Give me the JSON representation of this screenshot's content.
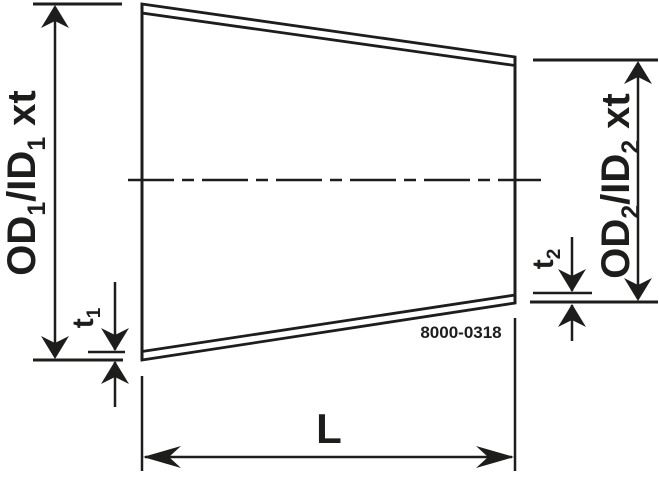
{
  "part_number": "8000-0318",
  "labels": {
    "left_diameter": {
      "p1": "OD",
      "s1": "1",
      "p2": "/ID",
      "s2": "1",
      "p3": "xt"
    },
    "right_diameter": {
      "p1": "OD",
      "s1": "2",
      "p2": "/ID",
      "s2": "2",
      "p3": "xt"
    },
    "left_thickness": {
      "p1": "t",
      "s1": "1"
    },
    "right_thickness": {
      "p1": "t",
      "s1": "2"
    },
    "length": "L"
  },
  "colors": {
    "line": "#1d1d1b",
    "background": "#ffffff"
  }
}
